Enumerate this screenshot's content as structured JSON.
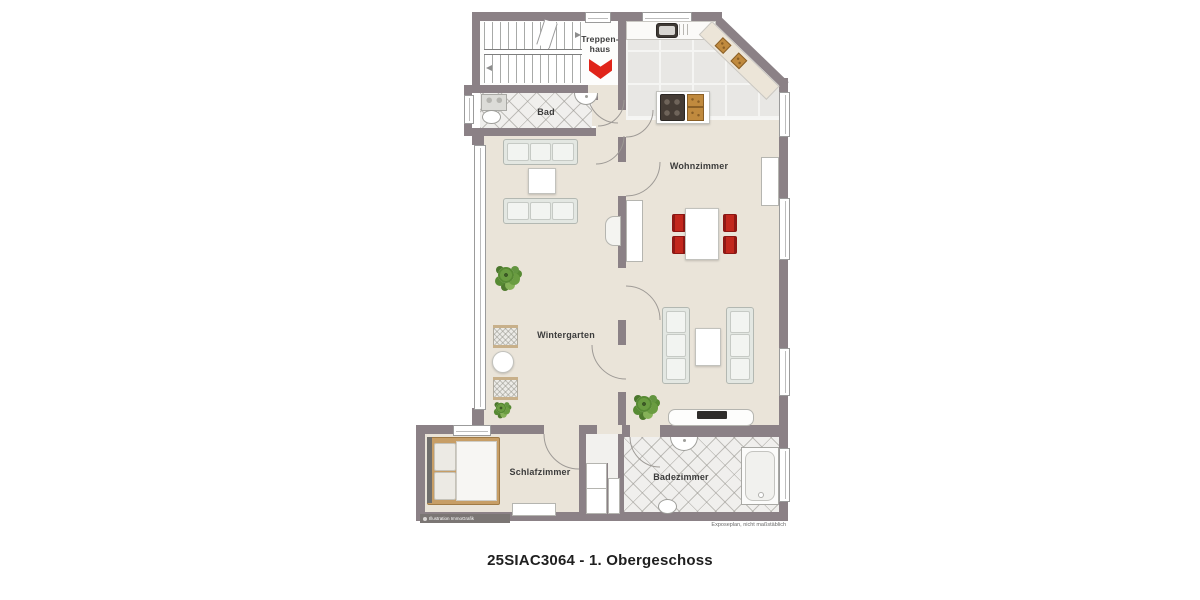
{
  "plan": {
    "caption": "25SIAC3064 - 1. Obergeschoss",
    "disclaimer": "Exposeplan, nicht maßstäblich",
    "watermark": "Illustration ImmoGrafik",
    "rooms": {
      "treppenhaus": "Treppen-\nhaus",
      "bad": "Bad",
      "wohnzimmer": "Wohnzimmer",
      "wintergarten": "Wintergarten",
      "schlafzimmer": "Schlafzimmer",
      "badezimmer": "Badezimmer"
    },
    "colors": {
      "wall": "#8b8186",
      "floor_beige": "#eae4d9",
      "tile_light": "#f0efed",
      "accent_red": "#e02419",
      "chair_red": "#a81e1a",
      "wood_bed": "#c79e66",
      "plant_green": "#6a9c41"
    }
  }
}
